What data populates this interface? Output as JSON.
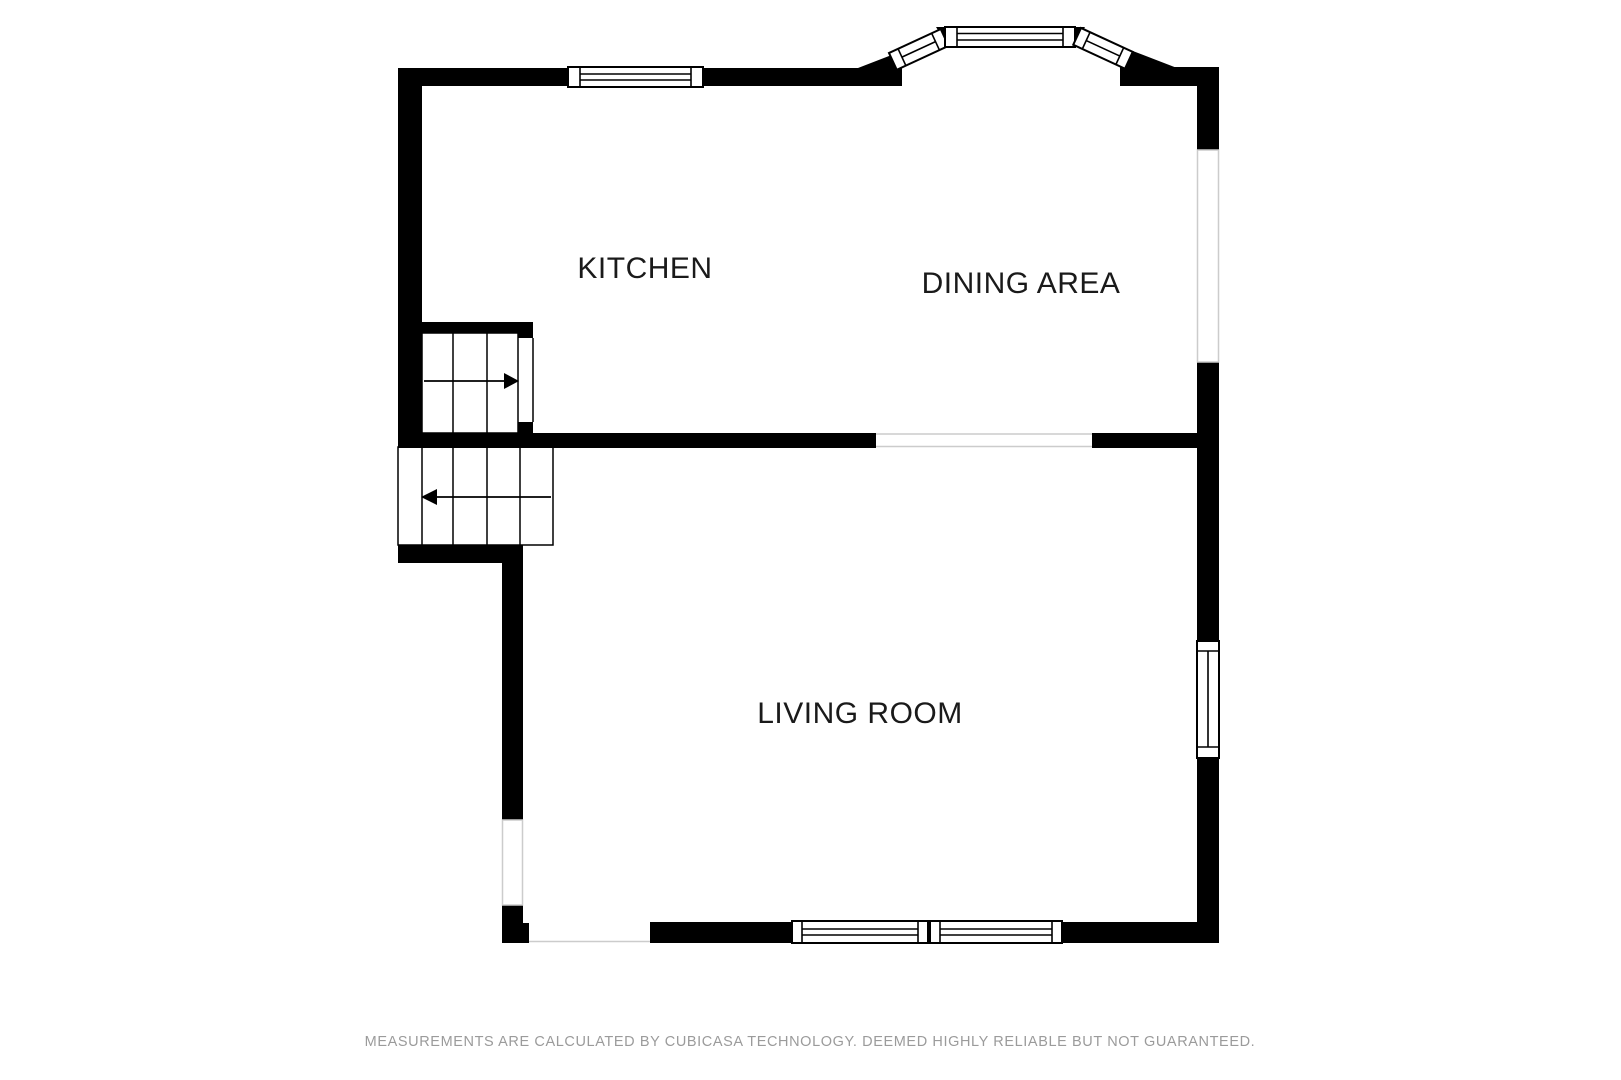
{
  "rooms": {
    "kitchen": {
      "label": "KITCHEN"
    },
    "dining": {
      "label": "DINING AREA"
    },
    "living": {
      "label": "LIVING ROOM"
    }
  },
  "stairs": {
    "upper_arrow_direction": "right",
    "lower_arrow_direction": "left"
  },
  "footer": {
    "disclaimer": "MEASUREMENTS ARE CALCULATED BY CUBICASA TECHNOLOGY. DEEMED HIGHLY RELIABLE BUT NOT GUARANTEED."
  },
  "colors": {
    "wall": "#000000",
    "background": "#ffffff",
    "label_text": "#1a1a1a",
    "footer_text": "#9b9b9b",
    "opening_line": "#cccccc"
  }
}
